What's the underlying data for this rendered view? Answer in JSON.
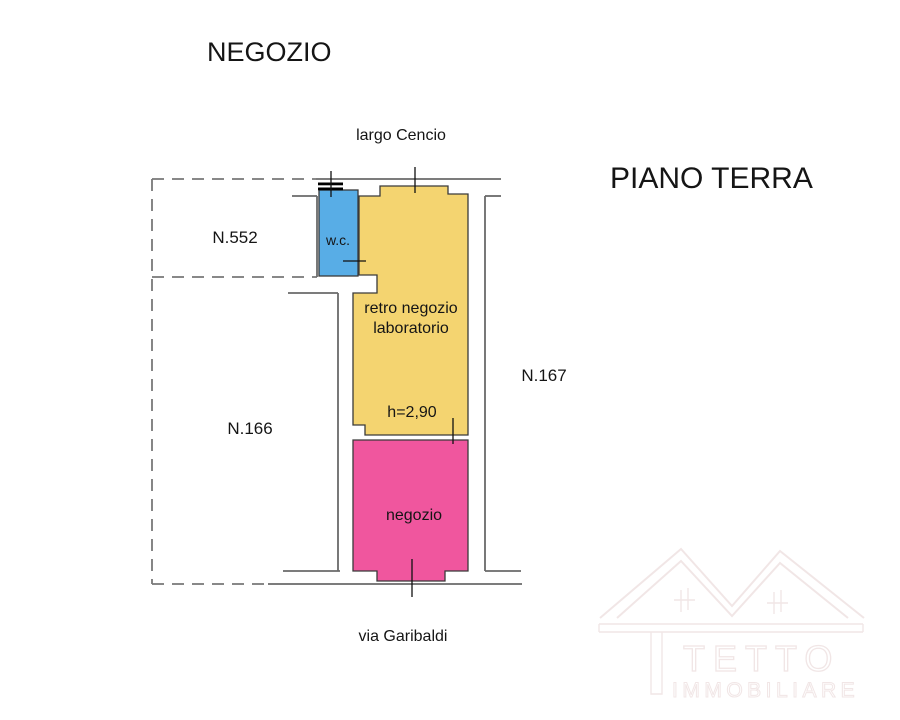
{
  "page": {
    "title_main": "NEGOZIO",
    "title_floor": "PIANO TERRA"
  },
  "streets": {
    "top": "largo Cencio",
    "bottom": "via Garibaldi"
  },
  "parcels": {
    "n552": "N.552",
    "n166": "N.166",
    "n167": "N.167"
  },
  "rooms": {
    "wc": {
      "label": "w.c.",
      "color": "#58ade6"
    },
    "retro": {
      "label_line1": "retro negozio",
      "label_line2": "laboratorio",
      "height_note": "h=2,90",
      "color": "#f4d470"
    },
    "negozio": {
      "label": "negozio",
      "color": "#f0569e"
    }
  },
  "watermark": {
    "brand": "TETTO",
    "subtitle": "IMMOBILIARE",
    "color": "#f1e6e6"
  },
  "colors": {
    "wall": "#6a6a6a",
    "dashed_boundary": "#787878",
    "text": "#151515",
    "background": "#ffffff"
  }
}
